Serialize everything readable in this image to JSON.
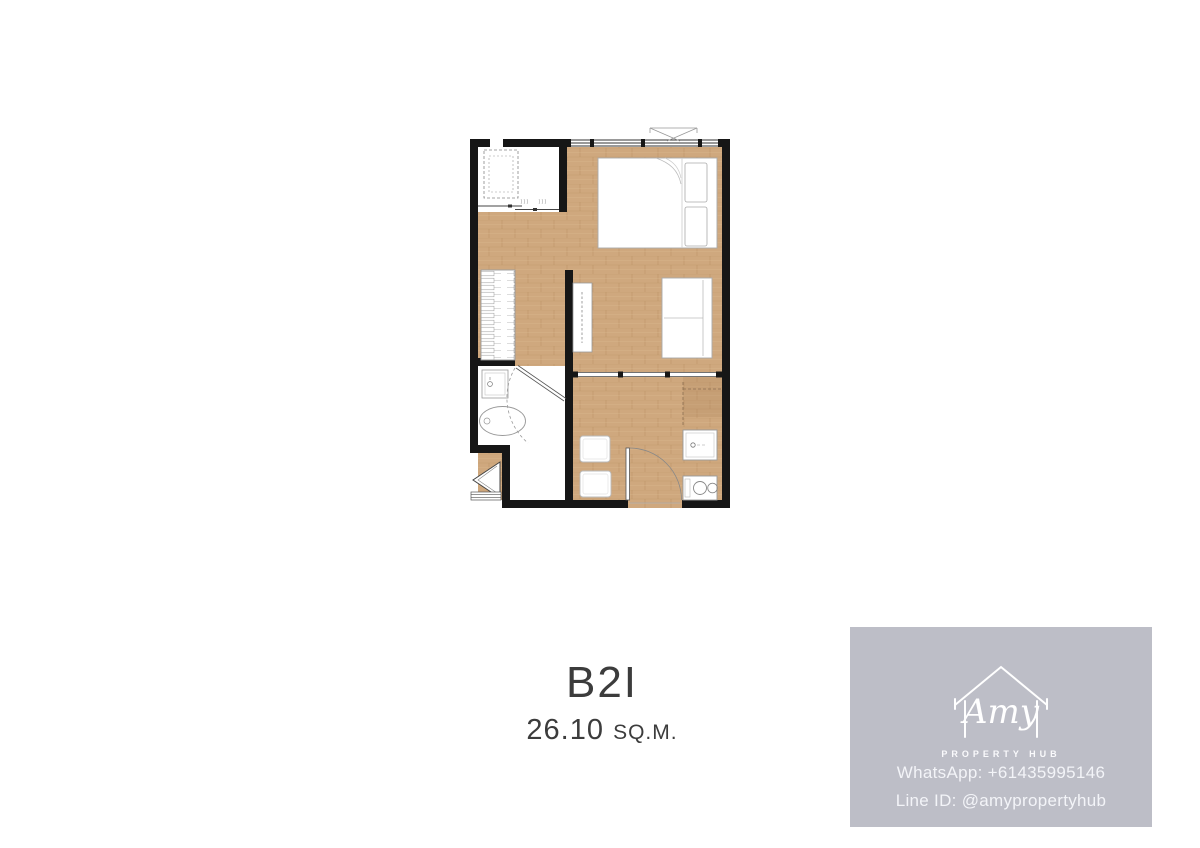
{
  "unit": {
    "name": "B2I",
    "area_value": "26.10",
    "area_unit": "SQ.M."
  },
  "branding": {
    "logo_name": "Amy",
    "logo_tagline": "PROPERTY HUB",
    "whatsapp": "WhatsApp: +61435995146",
    "line_id": "Line ID: @amypropertyhub",
    "panel_color": "#bdbec7",
    "text_color": "#f3f4f8"
  },
  "floorplan": {
    "colors": {
      "wall": "#161616",
      "wood_floor": "#cfa87e",
      "white_floor": "#ffffff",
      "furniture_outline": "#9a9a9a"
    },
    "rooms": [
      "balcony",
      "bedroom",
      "hallway",
      "living-room",
      "bathroom",
      "kitchen-dining"
    ]
  }
}
